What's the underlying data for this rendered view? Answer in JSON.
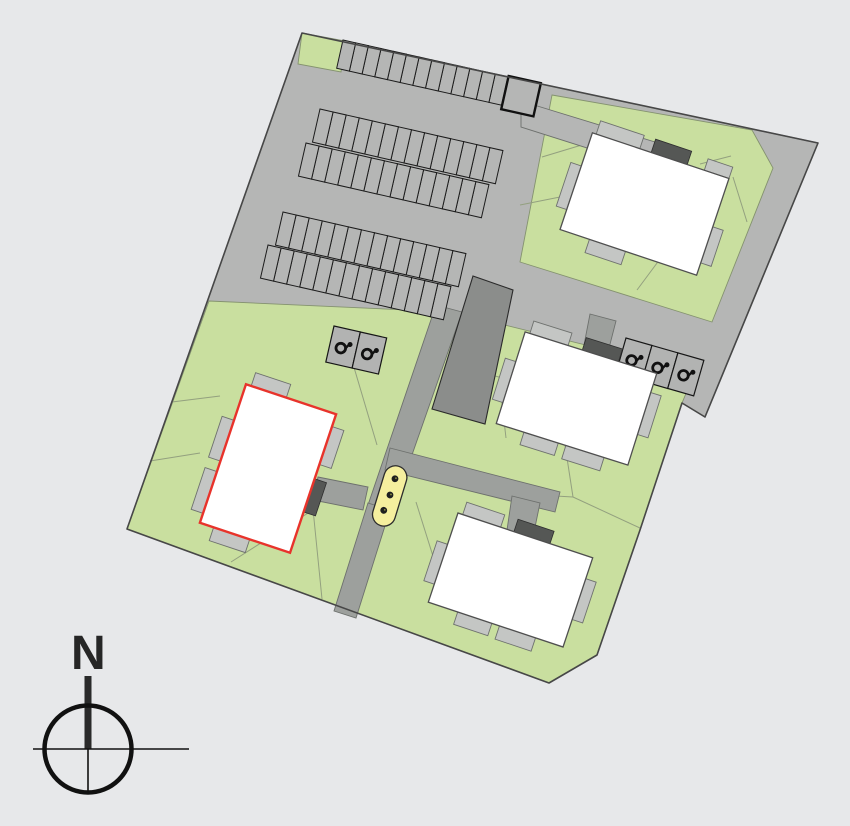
{
  "compass": {
    "north_label": "N"
  },
  "palette": {
    "background": "#e7e8ea",
    "road_gray": "#b5b6b5",
    "path_gray": "#9da09d",
    "green": "#c9df9f",
    "building_white": "#ffffff",
    "balcony_gray": "#c4c6c4",
    "entrance_gray": "#555755",
    "dark_structure": "#8b8d8b",
    "highlight_red": "#e8332b",
    "play_area_yellow": "#f5ef9e",
    "ink": "#111111"
  },
  "site": {
    "buildings": [
      {
        "id": "building-north",
        "highlighted": false
      },
      {
        "id": "building-east",
        "highlighted": false
      },
      {
        "id": "building-south",
        "highlighted": false
      },
      {
        "id": "building-west",
        "highlighted": true,
        "outline_color": "#e8332b"
      }
    ],
    "parking": {
      "top_row_stalls": 13,
      "garage_boxes": 1,
      "block_a_stalls_per_row": 14,
      "block_b_stalls_per_row": 14,
      "accessible_stalls_west": 2,
      "accessible_stalls_east": 3
    },
    "play_area": {
      "marker_dots": 3
    }
  }
}
